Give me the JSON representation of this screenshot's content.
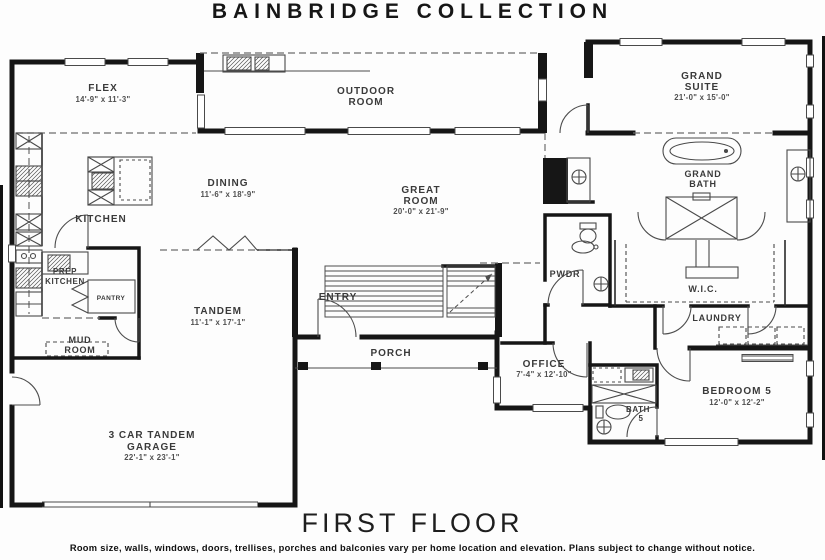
{
  "header": {
    "title": "BAINBRIDGE COLLECTION"
  },
  "footer": {
    "floor_label": "FIRST FLOOR",
    "disclaimer": "Room size, walls, windows, doors, trellises, porches and balconies vary per home location and elevation. Plans subject to change without notice."
  },
  "rooms": {
    "flex": {
      "name": "FLEX",
      "dims": "14'-9\" x 11'-3\""
    },
    "outdoor_room": {
      "line1": "OUTDOOR",
      "line2": "ROOM"
    },
    "grand_suite": {
      "line1": "GRAND",
      "line2": "SUITE",
      "dims": "21'-0\" x 15'-0\""
    },
    "kitchen": {
      "name": "KITCHEN"
    },
    "dining": {
      "name": "DINING",
      "dims": "11'-6\" x 18'-9\""
    },
    "great_room": {
      "line1": "GREAT",
      "line2": "ROOM",
      "dims": "20'-0\" x 21'-9\""
    },
    "grand_bath": {
      "line1": "GRAND",
      "line2": "BATH"
    },
    "prep_kitchen": {
      "line1": "PREP",
      "line2": "KITCHEN"
    },
    "pantry": {
      "name": "PANTRY"
    },
    "pwdr": {
      "name": "PWDR"
    },
    "wic": {
      "name": "W.I.C."
    },
    "mud_room": {
      "line1": "MUD",
      "line2": "ROOM"
    },
    "tandem": {
      "name": "TANDEM",
      "dims": "11'-1\" x 17'-1\""
    },
    "entry": {
      "name": "ENTRY"
    },
    "porch": {
      "name": "PORCH"
    },
    "laundry": {
      "name": "LAUNDRY"
    },
    "office": {
      "name": "OFFICE",
      "dims": "7'-4\" x 12'-10\""
    },
    "garage": {
      "line1": "3 CAR TANDEM",
      "line2": "GARAGE",
      "dims": "22'-1\" x 23'-1\""
    },
    "bath5": {
      "line1": "BATH",
      "line2": "5"
    },
    "bedroom5": {
      "name": "BEDROOM 5",
      "dims": "12'-0\" x 12'-2\""
    }
  }
}
